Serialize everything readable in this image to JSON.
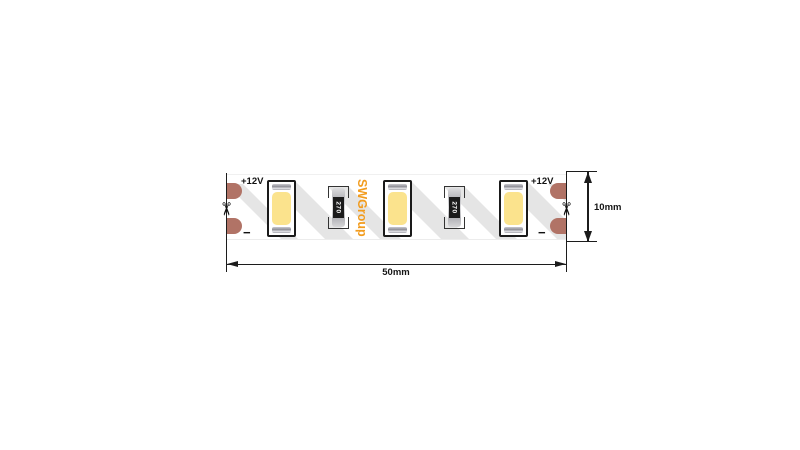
{
  "strip": {
    "brand_text": "SWGroup",
    "voltage_left": "+12V",
    "voltage_right": "+12V",
    "minus_left": "−",
    "minus_right": "−",
    "resistors": [
      {
        "value": "270"
      },
      {
        "value": "270"
      }
    ],
    "led_count": 3
  },
  "dimensions": {
    "width_label": "50mm",
    "height_label": "10mm"
  },
  "icons": {
    "scissors_glyph": "✂"
  },
  "colors": {
    "background": "#ffffff",
    "copper_pad": "#b17366",
    "brand_orange": "#f29c1e",
    "led_yellow": "#fbe38d",
    "shadow_gray": "#e5e5e5",
    "line": "#1c1c1c"
  }
}
